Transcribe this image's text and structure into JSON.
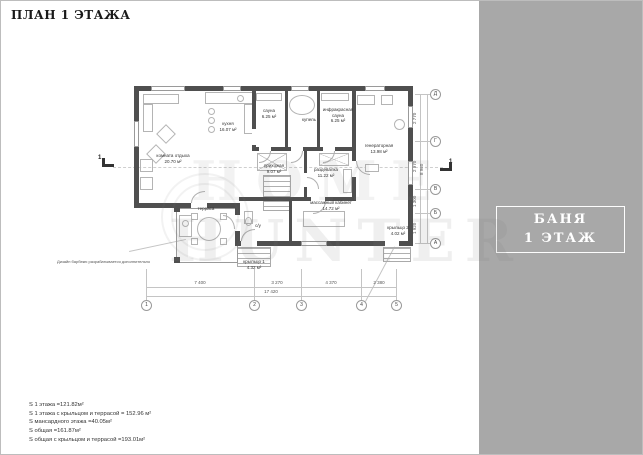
{
  "page": {
    "title": "ПЛАН 1 ЭТАЖА"
  },
  "sidebar": {
    "line1": "БАНЯ",
    "line2": "1 ЭТАЖ"
  },
  "watermark": {
    "line1": "HOME",
    "line2": "HUNTER"
  },
  "note": "Дизайн барбекю разрабатывается дополнительно",
  "rooms": [
    {
      "name": "комната отдыха",
      "area": "20.70 м²"
    },
    {
      "name": "кухня",
      "area": "16.07 м²"
    },
    {
      "name": "сауна",
      "area": "6.25 м²"
    },
    {
      "name": "купель",
      "area": ""
    },
    {
      "name": "инфракрасная сауна",
      "area": "6.25 м²"
    },
    {
      "name": "генераторная",
      "area": "13.98 м²"
    },
    {
      "name": "прихожая",
      "area": "9.07 м²"
    },
    {
      "name": "раздевалка",
      "area": "11.22 м²"
    },
    {
      "name": "массажный кабинет",
      "area": "14.72 м²"
    },
    {
      "name": "терраса",
      "area": ""
    },
    {
      "name": "с/у",
      "area": ""
    },
    {
      "name": "крыльцо 1",
      "area": "4.32 м²"
    },
    {
      "name": "крыльцо 2",
      "area": "4.02 м²"
    }
  ],
  "dimensions": {
    "bottom": [
      "7 400",
      "3 270",
      "4 370",
      "2 380"
    ],
    "bottom_total": "17 420",
    "right": [
      "2 770",
      "2 970",
      "1 300",
      "1 920"
    ],
    "right_total": "8 960",
    "axes_bottom": [
      "1",
      "2",
      "3",
      "4",
      "5"
    ],
    "axes_right": [
      "Д",
      "Г",
      "В",
      "Б",
      "А"
    ],
    "section_marker": "1"
  },
  "areas_summary": [
    "S 1 этажа =121.82м²",
    "S 1 этажа с крыльцом и террасой = 152.96 м²",
    "S мансардного этажа =40.05м²",
    "S общая =161.87м²",
    "S общая с крыльцом и террасой =193.01м²"
  ],
  "colors": {
    "sidebar": "#a8a8a8",
    "wall": "#4f4f4f",
    "thin_line": "#c4c4c4"
  }
}
